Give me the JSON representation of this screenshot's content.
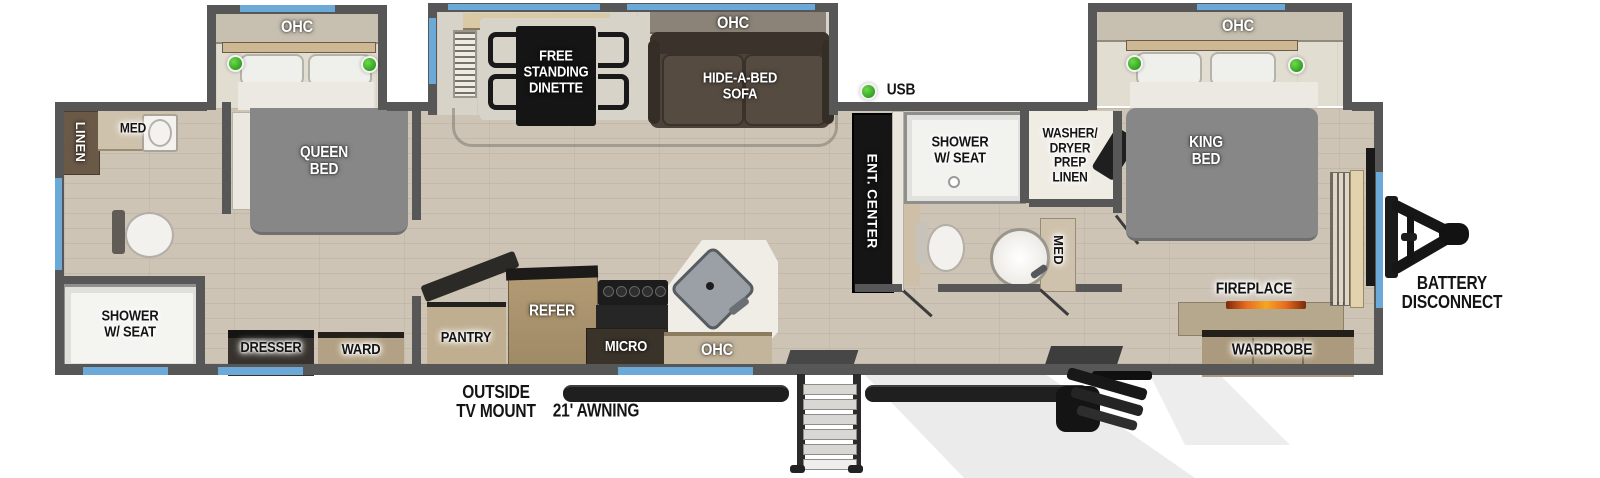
{
  "areas": {
    "rear_bath": {
      "linen": "LINEN",
      "med": "MED",
      "shower": "SHOWER\nW/ SEAT"
    },
    "rear_bedroom": {
      "ohc": "OHC",
      "bed": "QUEEN\nBED",
      "dresser": "DRESSER",
      "ward": "WARD"
    },
    "living": {
      "ohc": "OHC",
      "dinette": "FREE\nSTANDING\nDINETTE",
      "sofa": "HIDE-A-BED\nSOFA",
      "ent_center": "ENT. CENTER",
      "usb": "USB"
    },
    "kitchen": {
      "pantry": "PANTRY",
      "refer": "REFER",
      "micro": "MICRO",
      "ohc": "OHC"
    },
    "main_bath": {
      "shower": "SHOWER\nW/ SEAT",
      "washer_dryer": "WASHER/\nDRYER\nPREP\nLINEN",
      "med": "MED"
    },
    "front_bedroom": {
      "ohc": "OHC",
      "bed": "KING\nBED",
      "fireplace": "FIREPLACE",
      "wardrobe": "WARDROBE"
    },
    "exterior": {
      "tv_mount": "OUTSIDE\nTV MOUNT",
      "awning": "21' AWNING",
      "battery": "BATTERY\nDISCONNECT"
    }
  },
  "indicators": {
    "reading_light_count": 4,
    "usb_port_count": 1
  },
  "colors": {
    "wall": "#575757",
    "floor_wood": "#cdc4b6",
    "window_blue": "#6aa9d8",
    "indicator_green": "#3fae2b",
    "bed_gray": "#878787",
    "sofa_brown": "#4c423a",
    "cabinet_wood": "#ab9a7d",
    "counter_white": "#f0ede7",
    "fixture_black": "#151515"
  }
}
